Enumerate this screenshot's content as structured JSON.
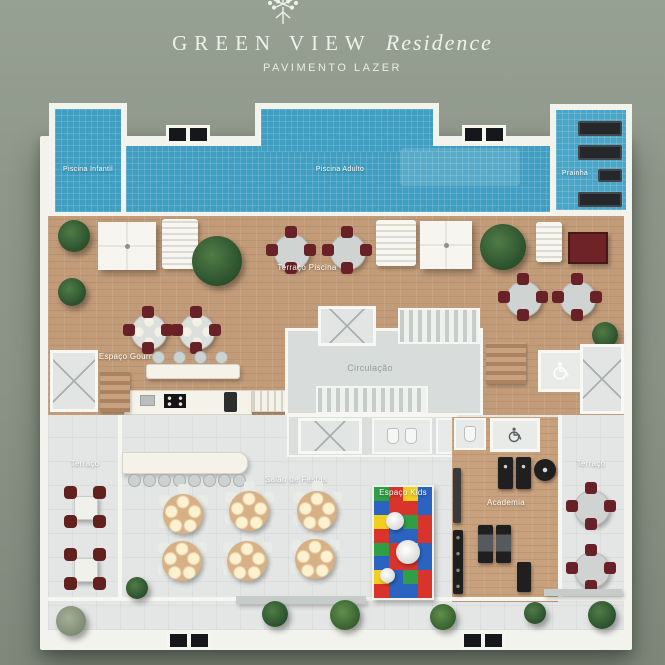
{
  "header": {
    "brand": "GREEN VIEW",
    "brand_script": "Residence",
    "subtitle": "PAVIMENTO LAZER"
  },
  "areas": {
    "piscina_infantil": "Piscina Infantil",
    "piscina_adulto": "Piscina Adulto",
    "prainha": "Prainha",
    "terraco_piscina": "Terraço Piscina",
    "espaco_gourmet": "Espaço Gourmet",
    "circulacao": "Circulação",
    "terraco_esquerdo": "Terraço",
    "salao_de_festas": "Salão de Festas",
    "espaco_kids": "Espaço Kids",
    "academia": "Academia",
    "terraco_direito": "Terraço"
  },
  "icons": {
    "logo": "tree-icon",
    "accessibility": "wheelchair-icon"
  },
  "colors": {
    "background": "#8e9789",
    "pool": "#3f9ec2",
    "deck_wood": "#c29c79",
    "floor_light": "#e3e6e5",
    "plan_border": "#f3f3ee",
    "chair_accent": "#682227",
    "banquet_table": "#d7b185"
  },
  "kids_palette": [
    "#2f9e44",
    "#d9342b",
    "#f2cf1f",
    "#2b63c0"
  ]
}
